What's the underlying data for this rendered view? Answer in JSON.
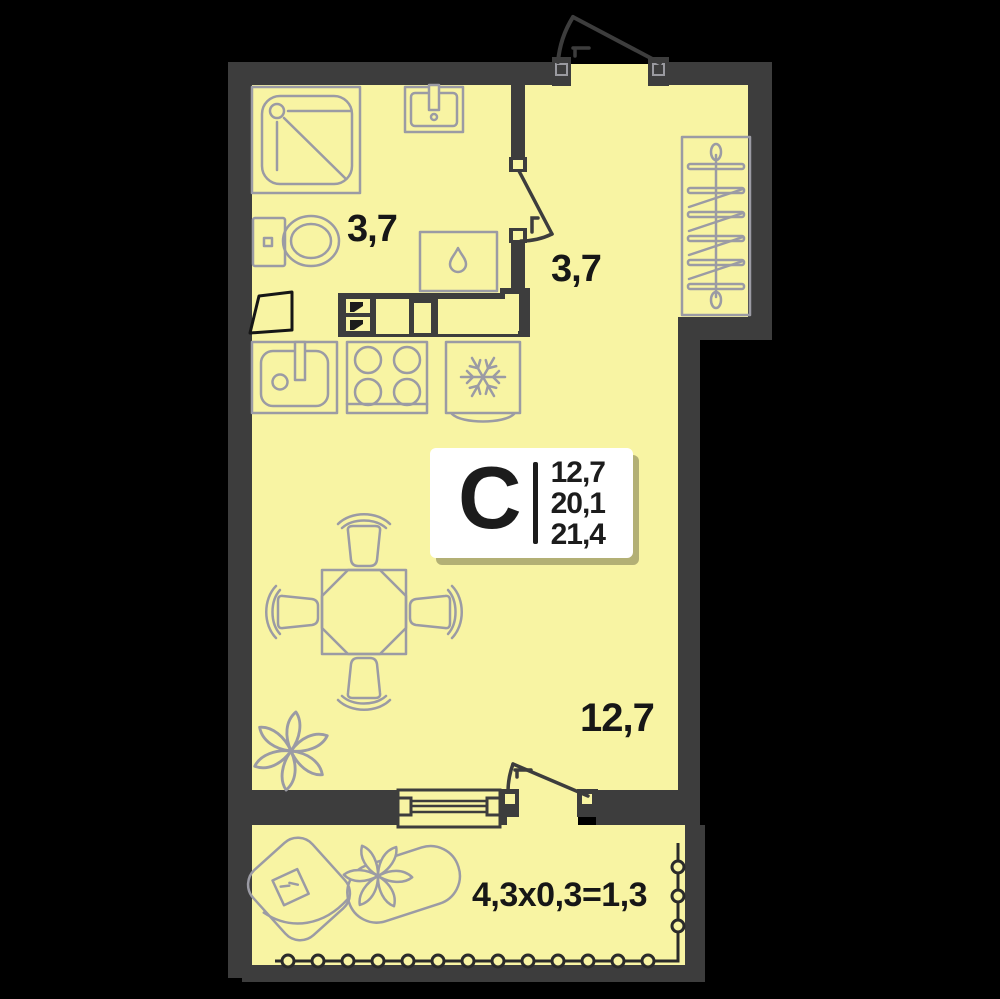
{
  "plan": {
    "unit": {
      "type_label": "С",
      "stats": [
        "12,7",
        "20,1",
        "21,4"
      ]
    },
    "rooms": [
      {
        "name": "bathroom",
        "area_label": "3,7"
      },
      {
        "name": "hallway",
        "area_label": "3,7"
      },
      {
        "name": "living-room",
        "area_label": "12,7"
      },
      {
        "name": "balcony",
        "area_label": "4,3x0,3=1,3"
      }
    ],
    "colors": {
      "background": "#000000",
      "wall": "#3d3d3d",
      "room-fill": "#f8f4a3",
      "furniture-line": "#9b9ba4",
      "railing-line": "#2b2b2b",
      "text": "#171717",
      "info-box-bg": "#ffffff"
    },
    "icons": {
      "shower-icon": "svg-shape",
      "bath-sink-icon": "svg-shape",
      "toilet-icon": "svg-shape",
      "washing-machine-icon": "svg-shape-with-drop",
      "kitchen-sink-icon": "svg-shape",
      "stove-icon": "svg-4-burners",
      "fridge-icon": "svg-snowflake",
      "wardrobe-icon": "svg-rod-with-hangers",
      "dining-table-icon": "svg-octagon-table",
      "chair-icon": "svg-shape",
      "plant-icon": "svg-flower",
      "armchair-icon": "svg-shape",
      "planter-icon": "svg-capsule-flower",
      "entrance-door-icon": "svg-door-swing",
      "interior-door-icon": "svg-door-swing",
      "balcony-door-icon": "svg-door-swing",
      "window-icon": "svg-triple-line",
      "railing-icon": "svg-line-with-posts",
      "vent-shaft-icon": "svg-flag"
    }
  }
}
